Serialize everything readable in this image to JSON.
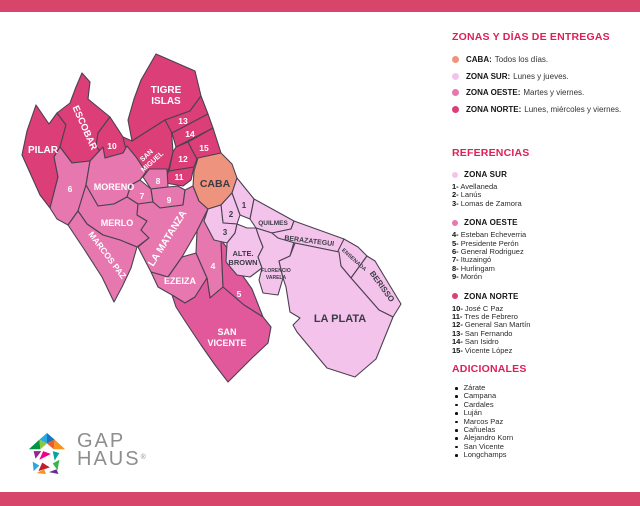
{
  "colors": {
    "accent": "#de2059",
    "band": "#d7456a",
    "outline": "#4a4150",
    "label_light": "#ffffff",
    "label_dark": "#3b3b44",
    "zones": {
      "caba": "#ee937e",
      "sur": "#f4c3ec",
      "oeste": "#e677af",
      "oeste2": "#e2599b",
      "norte": "#dc3e78"
    }
  },
  "delivery": {
    "title": "ZONAS Y DÍAS DE ENTREGAS",
    "items": [
      {
        "zone": "caba",
        "label": "CABA:",
        "text": "Todos los días."
      },
      {
        "zone": "sur",
        "label": "ZONA SUR:",
        "text": "Lunes y jueves."
      },
      {
        "zone": "oeste",
        "label": "ZONA OESTE:",
        "text": "Martes y viernes."
      },
      {
        "zone": "norte",
        "label": "ZONA NORTE:",
        "text": "Lunes, miércoles y viernes."
      }
    ]
  },
  "referencias": {
    "title": "REFERENCIAS",
    "groups": [
      {
        "zone": "sur",
        "name": "ZONA SUR",
        "items": [
          {
            "num": "1-",
            "name": "Avellaneda"
          },
          {
            "num": "2-",
            "name": "Lanús"
          },
          {
            "num": "3-",
            "name": "Lomas de Zamora"
          }
        ]
      },
      {
        "zone": "oeste",
        "name": "ZONA OESTE",
        "items": [
          {
            "num": "4-",
            "name": "Esteban Echeverria"
          },
          {
            "num": "5-",
            "name": "Presidente Perón"
          },
          {
            "num": "6-",
            "name": "General Rodriguez"
          },
          {
            "num": "7-",
            "name": "Ituzaingó"
          },
          {
            "num": "8-",
            "name": "Hurlingam"
          },
          {
            "num": "9-",
            "name": "Morón"
          }
        ]
      },
      {
        "zone": "norte",
        "name": "ZONA NORTE",
        "items": [
          {
            "num": "10-",
            "name": "José C Paz"
          },
          {
            "num": "11-",
            "name": "Tres de Febrero"
          },
          {
            "num": "12-",
            "name": "General San Martín"
          },
          {
            "num": "13-",
            "name": "San Fernando"
          },
          {
            "num": "14-",
            "name": "San Isidro"
          },
          {
            "num": "15-",
            "name": "Vicente López"
          }
        ]
      }
    ]
  },
  "adicionales": {
    "title": "ADICIONALES",
    "items": [
      "Zárate",
      "Campana",
      "Cardales",
      "Luján",
      "Marcos Paz",
      "Cañuelas",
      "Alejandro Korn",
      "San Vicente",
      "Longchamps"
    ]
  },
  "logo": {
    "line1": "GAP",
    "line2": "HAUS",
    "registered": "®"
  },
  "map": {
    "regions": [
      {
        "id": "pilar",
        "zone": "norte",
        "points": "26,80 39,99 47,88 56,100 50,122 44,132 48,152 40,183 30,170 12,130 17,106",
        "label": {
          "lines": [
            "PILAR"
          ],
          "x": 33,
          "y": 128,
          "size": 10,
          "rot": 0,
          "tone": "light"
        }
      },
      {
        "id": "escobar",
        "zone": "norte",
        "points": "72,48 80,57 78,74 100,92 88,108 93,122 80,136 62,138 50,122 56,100 47,88 60,78 66,62",
        "label": {
          "lines": [
            "ESCOBAR"
          ],
          "x": 72,
          "y": 104,
          "size": 9.5,
          "rot": 66,
          "tone": "light"
        }
      },
      {
        "id": "tigre-islas",
        "zone": "norte",
        "points": "146,29 185,46 191,71 180,86 166,91 155,95 122,116 118,95 124,74 131,55",
        "label": {
          "lines": [
            "TIGRE",
            "ISLAS"
          ],
          "x": 156,
          "y": 68,
          "size": 10,
          "rot": 0,
          "tone": "light",
          "dy": 11
        }
      },
      {
        "id": "zone-10",
        "zone": "norte",
        "points": "88,108 100,92 113,112 117,121 113,128 95,133 86,121",
        "label": {
          "lines": [
            "10"
          ],
          "x": 102,
          "y": 124,
          "size": 8.5,
          "rot": 0,
          "tone": "light"
        }
      },
      {
        "id": "san-miguel",
        "zone": "norte",
        "points": "113,112 122,116 155,95 161,99 163,127 159,143 155,153 145,162 136,147 126,132 115,121",
        "label": {
          "lines": [
            "SAN",
            "MIGUEL"
          ],
          "x": 138,
          "y": 132,
          "size": 7,
          "rot": -42,
          "tone": "light",
          "dy": 8.5
        }
      },
      {
        "id": "zone-13",
        "zone": "norte",
        "points": "155,95 166,91 180,86 191,71 198,89 162,108",
        "label": {
          "lines": [
            "13"
          ],
          "x": 173,
          "y": 99,
          "size": 8.5,
          "rot": 0,
          "tone": "light"
        }
      },
      {
        "id": "zone-14",
        "zone": "norte",
        "points": "162,108 198,89 203,103 166,122",
        "label": {
          "lines": [
            "14"
          ],
          "x": 180,
          "y": 112,
          "size": 8.5,
          "rot": 0,
          "tone": "light"
        }
      },
      {
        "id": "zone-15",
        "zone": "norte",
        "points": "178,117 203,103 211,128 187,134 182,125",
        "label": {
          "lines": [
            "15"
          ],
          "x": 194,
          "y": 126,
          "size": 8.5,
          "rot": 0,
          "tone": "light"
        }
      },
      {
        "id": "zone-12",
        "zone": "norte",
        "points": "166,122 178,117 182,125 187,134 184,142 159,146 163,127",
        "label": {
          "lines": [
            "12"
          ],
          "x": 173,
          "y": 137,
          "size": 8.5,
          "rot": 0,
          "tone": "light"
        }
      },
      {
        "id": "zone-11",
        "zone": "norte",
        "points": "159,146 184,142 181,155 173,161 155,158 155,153",
        "label": {
          "lines": [
            "11"
          ],
          "x": 169,
          "y": 155,
          "size": 8.5,
          "rot": 0,
          "tone": "light"
        }
      },
      {
        "id": "zone-6",
        "zone": "oeste",
        "points": "40,183 48,152 44,132 50,122 62,138 80,136 76,160 68,186 58,200 47,194",
        "label": {
          "lines": [
            "6"
          ],
          "x": 60,
          "y": 167,
          "size": 8.5,
          "rot": 0,
          "tone": "light"
        }
      },
      {
        "id": "moreno",
        "zone": "oeste",
        "points": "80,136 93,122 95,133 113,128 117,121 126,132 136,147 130,155 121,160 117,172 104,179 88,181 76,160",
        "label": {
          "lines": [
            "MORENO"
          ],
          "x": 104,
          "y": 165,
          "size": 9,
          "rot": 0,
          "tone": "light"
        }
      },
      {
        "id": "zone-8",
        "zone": "oeste",
        "points": "139,144 157,144 158,162 141,164 133,152",
        "label": {
          "lines": [
            "8"
          ],
          "x": 148,
          "y": 159,
          "size": 8.5,
          "rot": 0,
          "tone": "light"
        }
      },
      {
        "id": "zone-7",
        "zone": "oeste",
        "points": "121,160 130,155 141,164 143,177 128,179 117,172",
        "label": {
          "lines": [
            "7"
          ],
          "x": 132,
          "y": 174,
          "size": 8.5,
          "rot": 0,
          "tone": "light"
        }
      },
      {
        "id": "zone-9",
        "zone": "oeste",
        "points": "141,164 158,162 168,161 175,165 173,180 150,183 143,177",
        "label": {
          "lines": [
            "9"
          ],
          "x": 159,
          "y": 178,
          "size": 8.5,
          "rot": 0,
          "tone": "light"
        }
      },
      {
        "id": "merlo",
        "zone": "oeste",
        "points": "68,186 76,160 88,181 104,179 117,172 128,179 127,190 137,196 131,205 139,213 127,222 110,215 93,210 77,199",
        "label": {
          "lines": [
            "MERLO"
          ],
          "x": 107,
          "y": 201,
          "size": 9,
          "rot": 0,
          "tone": "light"
        }
      },
      {
        "id": "marcos-paz",
        "zone": "oeste",
        "points": "58,200 68,186 77,199 93,210 110,215 127,222 121,243 112,262 104,277 92,252 74,224",
        "label": {
          "lines": [
            "MARCOS PAZ"
          ],
          "x": 95,
          "y": 232,
          "size": 8.5,
          "rot": 53,
          "tone": "light"
        }
      },
      {
        "id": "la-matanza",
        "zone": "oeste",
        "points": "127,190 128,179 143,177 150,183 173,180 175,165 183,161 189,176 198,184 187,206 172,232 158,252 141,247 128,222 139,213 131,205 137,196",
        "label": {
          "lines": [
            "LA MATANZA"
          ],
          "x": 160,
          "y": 215,
          "size": 10,
          "rot": -58,
          "tone": "light"
        }
      },
      {
        "id": "ezeiza",
        "zone": "oeste",
        "points": "141,247 158,252 172,232 186,228 197,253 185,272 175,278 162,270 148,262",
        "label": {
          "lines": [
            "EZEIZA"
          ],
          "x": 170,
          "y": 259,
          "size": 9,
          "rot": 0,
          "tone": "light"
        }
      },
      {
        "id": "zone-4",
        "zone": "oeste",
        "points": "187,206 198,184 204,190 211,215 213,262 200,273 197,253 186,228",
        "label": {
          "lines": [
            "4"
          ],
          "x": 203,
          "y": 244,
          "size": 8.5,
          "rot": 0,
          "tone": "light"
        }
      },
      {
        "id": "zone-5",
        "zone": "oeste2",
        "points": "211,215 225,233 230,247 242,264 253,292 234,280 213,262",
        "label": {
          "lines": [
            "5"
          ],
          "x": 229,
          "y": 272,
          "size": 8.5,
          "rot": 0,
          "tone": "light"
        }
      },
      {
        "id": "san-vicente",
        "zone": "oeste2",
        "points": "162,270 175,278 185,272 197,253 200,273 213,262 234,280 253,292 261,302 258,318 243,332 229,346 218,357 205,340 191,320 177,299 166,282",
        "label": {
          "lines": [
            "SAN",
            "VICENTE"
          ],
          "x": 217,
          "y": 310,
          "size": 9,
          "rot": 0,
          "tone": "light",
          "dy": 11
        }
      },
      {
        "id": "caba",
        "zone": "caba",
        "points": "188,133 211,128 222,139 227,153 222,168 211,180 198,184 189,176 183,161 184,146",
        "label": {
          "lines": [
            "CABA"
          ],
          "x": 205,
          "y": 162,
          "size": 10.5,
          "rot": 0,
          "tone": "dark"
        }
      },
      {
        "id": "zone-1",
        "zone": "sur",
        "points": "222,168 227,153 244,174 240,194 230,190",
        "label": {
          "lines": [
            "1"
          ],
          "x": 234,
          "y": 183,
          "size": 8,
          "rot": 0,
          "tone": "dark"
        }
      },
      {
        "id": "zone-2",
        "zone": "sur",
        "points": "211,180 222,168 230,190 227,199 213,198",
        "label": {
          "lines": [
            "2"
          ],
          "x": 221,
          "y": 192,
          "size": 8,
          "rot": 0,
          "tone": "dark"
        }
      },
      {
        "id": "zone-3",
        "zone": "sur",
        "points": "198,184 211,180 213,198 227,199 225,208 217,218 204,215 194,196",
        "label": {
          "lines": [
            "3"
          ],
          "x": 215,
          "y": 210,
          "size": 8,
          "rot": 0,
          "tone": "dark"
        }
      },
      {
        "id": "quilmes",
        "zone": "sur",
        "points": "244,174 284,196 281,204 262,208 246,203 240,194",
        "label": {
          "lines": [
            "QUILMES"
          ],
          "x": 263,
          "y": 200,
          "size": 6.5,
          "rot": 0,
          "tone": "dark"
        }
      },
      {
        "id": "alte-brown",
        "zone": "sur",
        "points": "217,218 225,208 227,199 237,203 246,203 249,212 253,222 248,232 252,243 240,252 227,250 216,237",
        "label": {
          "lines": [
            "ALTE.",
            "BROWN"
          ],
          "x": 233,
          "y": 231,
          "size": 7.5,
          "rot": 0,
          "tone": "dark",
          "dy": 9
        }
      },
      {
        "id": "florencio-varela",
        "zone": "sur",
        "points": "246,203 262,208 268,213 284,217 280,231 269,236 273,253 268,270 253,268 249,255 252,243 248,232 253,222 249,212",
        "label": {
          "lines": [
            "FLORENCIO",
            "VARELA"
          ],
          "x": 266,
          "y": 247,
          "size": 5,
          "rot": 0,
          "tone": "dark",
          "dy": 7
        }
      },
      {
        "id": "berazategui",
        "zone": "sur",
        "points": "284,196 334,214 329,227 285,218 268,213 262,208 281,204",
        "label": {
          "lines": [
            "BERAZATEGUI"
          ],
          "x": 299,
          "y": 218,
          "size": 7,
          "rot": 7,
          "tone": "dark"
        }
      },
      {
        "id": "ensenada",
        "zone": "sur",
        "points": "334,214 348,222 357,231 341,253 331,241 327,228",
        "label": {
          "lines": [
            "ENSENADA"
          ],
          "x": 343,
          "y": 236,
          "size": 5.5,
          "rot": 42,
          "tone": "dark"
        }
      },
      {
        "id": "berisso",
        "zone": "sur",
        "points": "357,231 365,236 391,279 383,292 369,285 341,253",
        "label": {
          "lines": [
            "BERISSO"
          ],
          "x": 370,
          "y": 263,
          "size": 8,
          "rot": 54,
          "tone": "dark"
        }
      },
      {
        "id": "la-plata",
        "zone": "sur",
        "points": "285,218 329,227 331,241 341,253 369,285 383,292 366,334 345,352 317,343 287,307 283,300 290,293 280,287 276,262 273,253 269,236 280,231",
        "label": {
          "lines": [
            "LA PLATA"
          ],
          "x": 330,
          "y": 297,
          "size": 11,
          "rot": 0,
          "tone": "dark"
        }
      }
    ]
  }
}
